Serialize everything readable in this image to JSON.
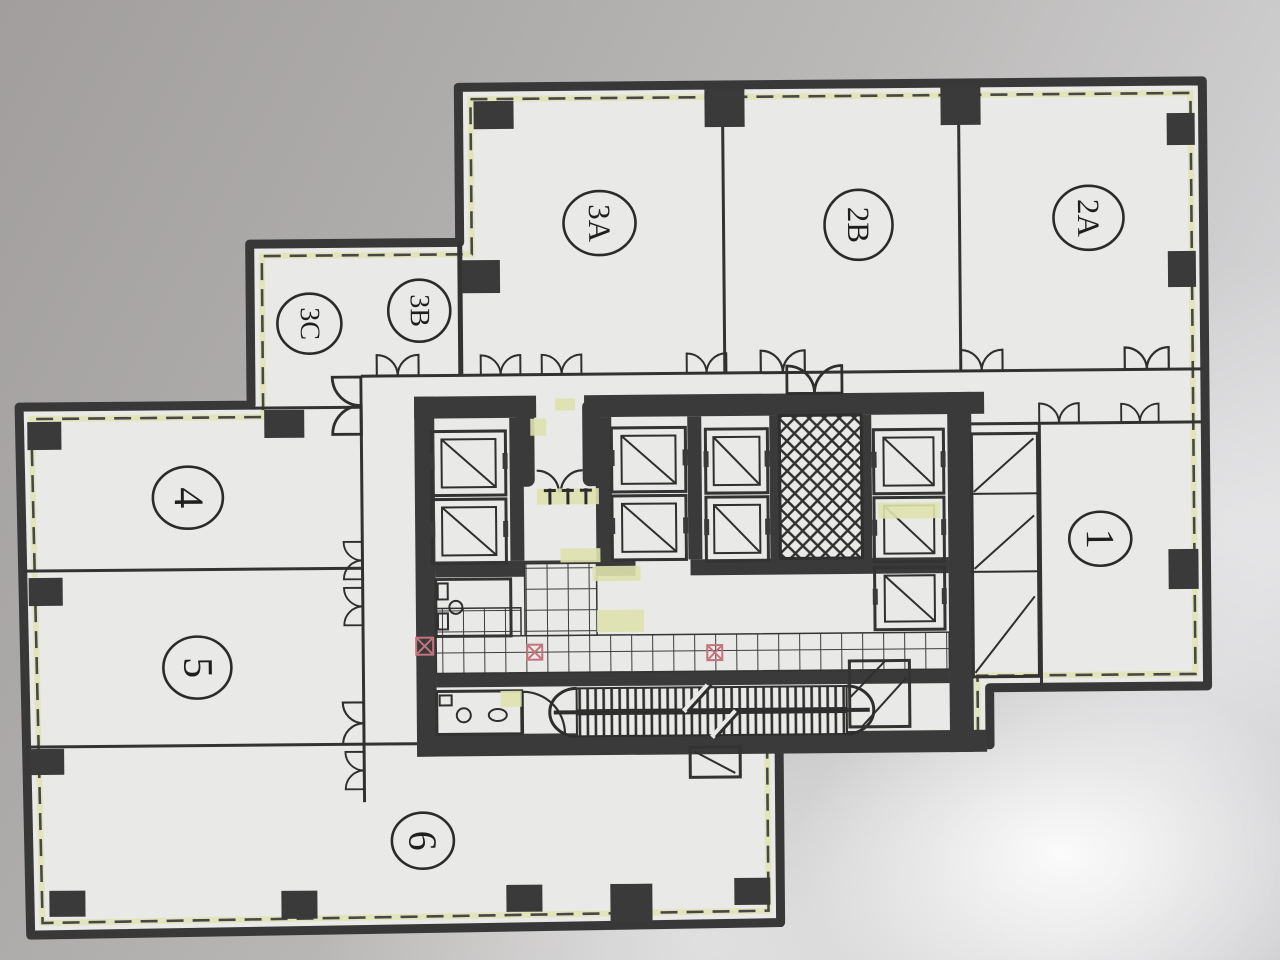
{
  "plan": {
    "title": "office-tower-typical-floor-plan",
    "units": [
      {
        "id": "3A",
        "label": "3A"
      },
      {
        "id": "2B",
        "label": "2B"
      },
      {
        "id": "2A",
        "label": "2A"
      },
      {
        "id": "3B",
        "label": "3B"
      },
      {
        "id": "3C",
        "label": "3C"
      },
      {
        "id": "4",
        "label": "4"
      },
      {
        "id": "5",
        "label": "5"
      },
      {
        "id": "6",
        "label": "6"
      },
      {
        "id": "1",
        "label": "1"
      }
    ],
    "colors": {
      "paper": "#e9e9e7",
      "ink": "#343434",
      "accent_yellow": "#dfe3ae",
      "accent_pink": "#c4747c",
      "background_dark": "#a19e9d",
      "background_light": "#d9d9db"
    }
  }
}
